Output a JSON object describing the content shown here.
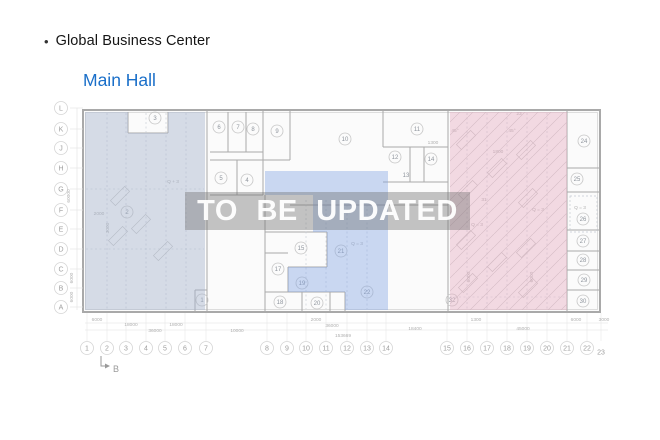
{
  "header": {
    "bullet": "•",
    "title": "Global Business Center",
    "hall_name": "Main Hall"
  },
  "watermark": {
    "text": "TO BE UPDATED"
  },
  "colors": {
    "hall_name": "#1a6fc9",
    "wall": "#a9a9a9",
    "wall_light": "#d0d0d0",
    "dash": "#c4c9d2",
    "booth": "#c2c2c2",
    "grid_text": "#9e9e9e",
    "room_text": "#8f959d",
    "dim_text": "#b0b0b0",
    "plan_fill": "#fbfbfb",
    "region_left": "rgba(166,180,203,0.45)",
    "region_middle": "rgba(130,165,226,0.42)",
    "region_right": "rgba(228,170,190,0.42)",
    "hatch_line": "#c9c9c9"
  },
  "plan": {
    "outer": {
      "x": 83,
      "y": 110,
      "w": 517,
      "h": 202
    },
    "walls": [
      [
        207,
        110,
        207,
        312
      ],
      [
        448,
        110,
        448,
        312
      ],
      [
        567,
        110,
        567,
        312
      ],
      [
        128,
        112,
        128,
        133
      ],
      [
        128,
        133,
        168,
        133
      ],
      [
        168,
        112,
        168,
        133
      ],
      [
        263,
        110,
        263,
        160
      ],
      [
        290,
        110,
        290,
        160
      ],
      [
        210,
        152,
        263,
        152
      ],
      [
        228,
        112,
        228,
        152
      ],
      [
        246,
        112,
        246,
        152
      ],
      [
        210,
        160,
        290,
        160
      ],
      [
        237,
        160,
        237,
        195
      ],
      [
        263,
        160,
        263,
        195
      ],
      [
        210,
        195,
        263,
        195
      ],
      [
        290,
        205,
        448,
        205
      ],
      [
        383,
        110,
        383,
        147
      ],
      [
        383,
        147,
        448,
        147
      ],
      [
        410,
        147,
        410,
        182
      ],
      [
        424,
        147,
        424,
        182
      ],
      [
        383,
        182,
        448,
        182
      ],
      [
        265,
        195,
        265,
        312
      ],
      [
        265,
        232,
        327,
        232
      ],
      [
        327,
        232,
        327,
        267
      ],
      [
        288,
        267,
        327,
        267
      ],
      [
        288,
        267,
        288,
        292
      ],
      [
        265,
        253,
        288,
        253
      ],
      [
        265,
        292,
        345,
        292
      ],
      [
        302,
        292,
        302,
        312
      ],
      [
        330,
        292,
        330,
        312
      ],
      [
        345,
        292,
        345,
        312
      ],
      [
        567,
        168,
        600,
        168
      ],
      [
        567,
        192,
        600,
        192
      ],
      [
        567,
        230,
        600,
        230
      ],
      [
        567,
        251,
        600,
        251
      ],
      [
        567,
        270,
        600,
        270
      ],
      [
        567,
        290,
        600,
        290
      ],
      [
        195,
        290,
        207,
        290
      ],
      [
        195,
        290,
        195,
        312
      ]
    ],
    "dashed": [
      [
        107,
        113,
        107,
        309
      ],
      [
        126,
        113,
        126,
        309
      ],
      [
        146,
        113,
        146,
        309
      ],
      [
        166,
        113,
        166,
        309
      ],
      [
        186,
        113,
        186,
        309
      ],
      [
        306,
        200,
        306,
        309
      ],
      [
        326,
        200,
        326,
        309
      ],
      [
        347,
        200,
        347,
        309
      ],
      [
        367,
        200,
        367,
        309
      ],
      [
        467,
        113,
        467,
        309
      ],
      [
        487,
        113,
        487,
        309
      ],
      [
        507,
        113,
        507,
        309
      ],
      [
        527,
        113,
        527,
        309
      ],
      [
        547,
        113,
        547,
        309
      ],
      [
        86,
        189,
        204,
        189
      ],
      [
        86,
        249,
        204,
        249
      ],
      [
        450,
        297,
        565,
        297
      ]
    ],
    "dashed_rect": {
      "x": 570,
      "y": 196,
      "w": 27,
      "h": 36
    },
    "booths": [
      {
        "x": 466,
        "y": 140
      },
      {
        "x": 468,
        "y": 190
      },
      {
        "x": 466,
        "y": 240
      },
      {
        "x": 468,
        "y": 283
      },
      {
        "x": 526,
        "y": 150
      },
      {
        "x": 528,
        "y": 198
      },
      {
        "x": 526,
        "y": 248
      },
      {
        "x": 528,
        "y": 288
      },
      {
        "x": 497,
        "y": 168
      },
      {
        "x": 497,
        "y": 262
      },
      {
        "x": 120,
        "y": 196
      },
      {
        "x": 141,
        "y": 224
      },
      {
        "x": 163,
        "y": 251
      },
      {
        "x": 118,
        "y": 236
      }
    ],
    "regions": [
      {
        "name": "left-hall",
        "points": "85,112 128,112 128,133 168,133 168,112 205,112 205,310 85,310",
        "fill": "region_left",
        "hatch": false
      },
      {
        "name": "middle-hall",
        "points": "265,171 388,171 388,310 345,310 345,292 288,292 288,267 327,267 327,232 313,232 313,195 265,195",
        "fill": "region_middle",
        "hatch": false
      },
      {
        "name": "right-hall",
        "points": "450,112 567,112 567,310 450,310",
        "fill": "region_right",
        "hatch": true
      }
    ],
    "rooms": [
      {
        "n": "3",
        "x": 155,
        "y": 118
      },
      {
        "n": "6",
        "x": 219,
        "y": 127
      },
      {
        "n": "7",
        "x": 238,
        "y": 127
      },
      {
        "n": "8",
        "x": 253,
        "y": 129
      },
      {
        "n": "9",
        "x": 277,
        "y": 131
      },
      {
        "n": "10",
        "x": 345,
        "y": 139
      },
      {
        "n": "11",
        "x": 417,
        "y": 129
      },
      {
        "n": "12",
        "x": 395,
        "y": 157
      },
      {
        "n": "14",
        "x": 431,
        "y": 159
      },
      {
        "n": "13",
        "x": 406,
        "y": 175,
        "nocircle": true
      },
      {
        "n": "5",
        "x": 221,
        "y": 178
      },
      {
        "n": "4",
        "x": 247,
        "y": 180
      },
      {
        "n": "2",
        "x": 127,
        "y": 212
      },
      {
        "n": "1",
        "x": 202,
        "y": 300
      },
      {
        "n": "15",
        "x": 301,
        "y": 248
      },
      {
        "n": "17",
        "x": 278,
        "y": 269
      },
      {
        "n": "19",
        "x": 302,
        "y": 283
      },
      {
        "n": "18",
        "x": 280,
        "y": 302
      },
      {
        "n": "20",
        "x": 317,
        "y": 303
      },
      {
        "n": "21",
        "x": 341,
        "y": 251
      },
      {
        "n": "22",
        "x": 367,
        "y": 292
      },
      {
        "n": "24",
        "x": 584,
        "y": 141
      },
      {
        "n": "25",
        "x": 577,
        "y": 179
      },
      {
        "n": "26",
        "x": 583,
        "y": 219
      },
      {
        "n": "27",
        "x": 583,
        "y": 241
      },
      {
        "n": "28",
        "x": 583,
        "y": 260
      },
      {
        "n": "29",
        "x": 584,
        "y": 280
      },
      {
        "n": "30",
        "x": 583,
        "y": 301
      },
      {
        "n": "32",
        "x": 452,
        "y": 300
      }
    ],
    "annotations": [
      {
        "t": "Q + 3",
        "x": 173,
        "y": 183
      },
      {
        "t": "2000",
        "x": 99,
        "y": 215
      },
      {
        "t": "3000",
        "x": 109,
        "y": 228,
        "r": -90
      },
      {
        "t": "Q = 3",
        "x": 357,
        "y": 245
      },
      {
        "t": "1300",
        "x": 433,
        "y": 144
      },
      {
        "t": "1800",
        "x": 498,
        "y": 153
      },
      {
        "t": "23",
        "x": 519,
        "y": 115
      },
      {
        "t": "31",
        "x": 484,
        "y": 201
      },
      {
        "t": "45°",
        "x": 455,
        "y": 132
      },
      {
        "t": "45°",
        "x": 512,
        "y": 132
      },
      {
        "t": "Q = 3",
        "x": 538,
        "y": 211
      },
      {
        "t": "Q = 3",
        "x": 477,
        "y": 226
      },
      {
        "t": "Q = 3",
        "x": 580,
        "y": 209
      },
      {
        "t": "6000",
        "x": 470,
        "y": 277,
        "r": -90
      },
      {
        "t": "6000",
        "x": 533,
        "y": 277,
        "r": -90
      }
    ],
    "row_axis": {
      "x": 61,
      "labels": [
        {
          "t": "L",
          "y": 108
        },
        {
          "t": "K",
          "y": 129
        },
        {
          "t": "J",
          "y": 148
        },
        {
          "t": "H",
          "y": 168
        },
        {
          "t": "G",
          "y": 189
        },
        {
          "t": "F",
          "y": 210
        },
        {
          "t": "E",
          "y": 229
        },
        {
          "t": "D",
          "y": 249
        },
        {
          "t": "C",
          "y": 269
        },
        {
          "t": "B",
          "y": 288
        },
        {
          "t": "A",
          "y": 307
        }
      ]
    },
    "col_axis": {
      "y": 348,
      "labels": [
        {
          "t": "1",
          "x": 87
        },
        {
          "t": "2",
          "x": 107
        },
        {
          "t": "3",
          "x": 126
        },
        {
          "t": "4",
          "x": 146
        },
        {
          "t": "5",
          "x": 165
        },
        {
          "t": "6",
          "x": 185
        },
        {
          "t": "7",
          "x": 206
        },
        {
          "t": "8",
          "x": 267
        },
        {
          "t": "9",
          "x": 287
        },
        {
          "t": "10",
          "x": 306
        },
        {
          "t": "11",
          "x": 326
        },
        {
          "t": "12",
          "x": 347
        },
        {
          "t": "13",
          "x": 367
        },
        {
          "t": "14",
          "x": 386
        },
        {
          "t": "15",
          "x": 447
        },
        {
          "t": "16",
          "x": 467
        },
        {
          "t": "17",
          "x": 487
        },
        {
          "t": "18",
          "x": 507
        },
        {
          "t": "19",
          "x": 527
        },
        {
          "t": "20",
          "x": 547
        },
        {
          "t": "21",
          "x": 567
        },
        {
          "t": "22",
          "x": 587
        },
        {
          "t": "23",
          "x": 601,
          "nocircle": true,
          "dy": 4
        }
      ]
    },
    "dims_bottom": [
      {
        "t": "6000",
        "x": 97,
        "y": 321
      },
      {
        "t": "2000",
        "x": 316,
        "y": 321
      },
      {
        "t": "1300",
        "x": 476,
        "y": 321
      },
      {
        "t": "6000",
        "x": 576,
        "y": 321
      },
      {
        "t": "3000",
        "x": 604,
        "y": 321
      },
      {
        "t": "18000",
        "x": 131,
        "y": 326
      },
      {
        "t": "18000",
        "x": 176,
        "y": 326
      },
      {
        "t": "36000",
        "x": 332,
        "y": 327
      },
      {
        "t": "18400",
        "x": 415,
        "y": 330
      },
      {
        "t": "45000",
        "x": 523,
        "y": 330
      },
      {
        "t": "36000",
        "x": 155,
        "y": 332
      },
      {
        "t": "10000",
        "x": 237,
        "y": 332
      },
      {
        "t": "153669",
        "x": 343,
        "y": 337
      }
    ],
    "dims_left": [
      {
        "t": "60000",
        "x": 70,
        "y": 196
      },
      {
        "t": "6000",
        "x": 73,
        "y": 278
      },
      {
        "t": "6000",
        "x": 73,
        "y": 297
      }
    ],
    "section_marker": {
      "label": "B",
      "x": 109,
      "y": 372
    }
  }
}
